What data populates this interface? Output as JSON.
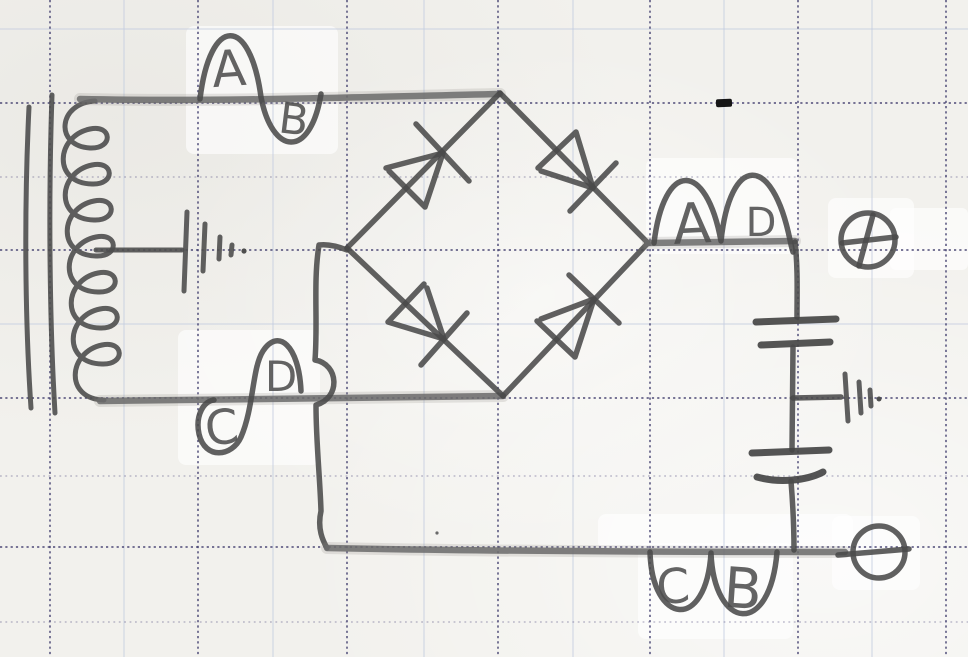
{
  "document": {
    "type": "hand-drawn circuit schematic on graph paper",
    "subject": "Transformer with grounded center tap feeding a four-diode bridge rectifier, two filter capacitors with grounded midpoint, and DC output terminals"
  },
  "waveform_labels": {
    "secondary_top_positive": "A",
    "secondary_top_negative": "B",
    "secondary_bottom_negative": "C",
    "secondary_bottom_positive": "D",
    "output_first": "A",
    "output_second": "D",
    "return_first": "C",
    "return_second": "B"
  },
  "terminal_symbols": {
    "positive": "+",
    "negative": "−"
  },
  "component_counts": {
    "diodes": 4,
    "capacitors": 2,
    "ground_symbols": 2,
    "terminals": 2
  },
  "colors": {
    "pencil": "#4e4e4e",
    "pencil_soft": "#6b6b6b",
    "paper": "#f2f1ed",
    "grid_major": "#413e6e",
    "grid_minor": "#c4cde0",
    "artifact_mark": "#161616"
  }
}
